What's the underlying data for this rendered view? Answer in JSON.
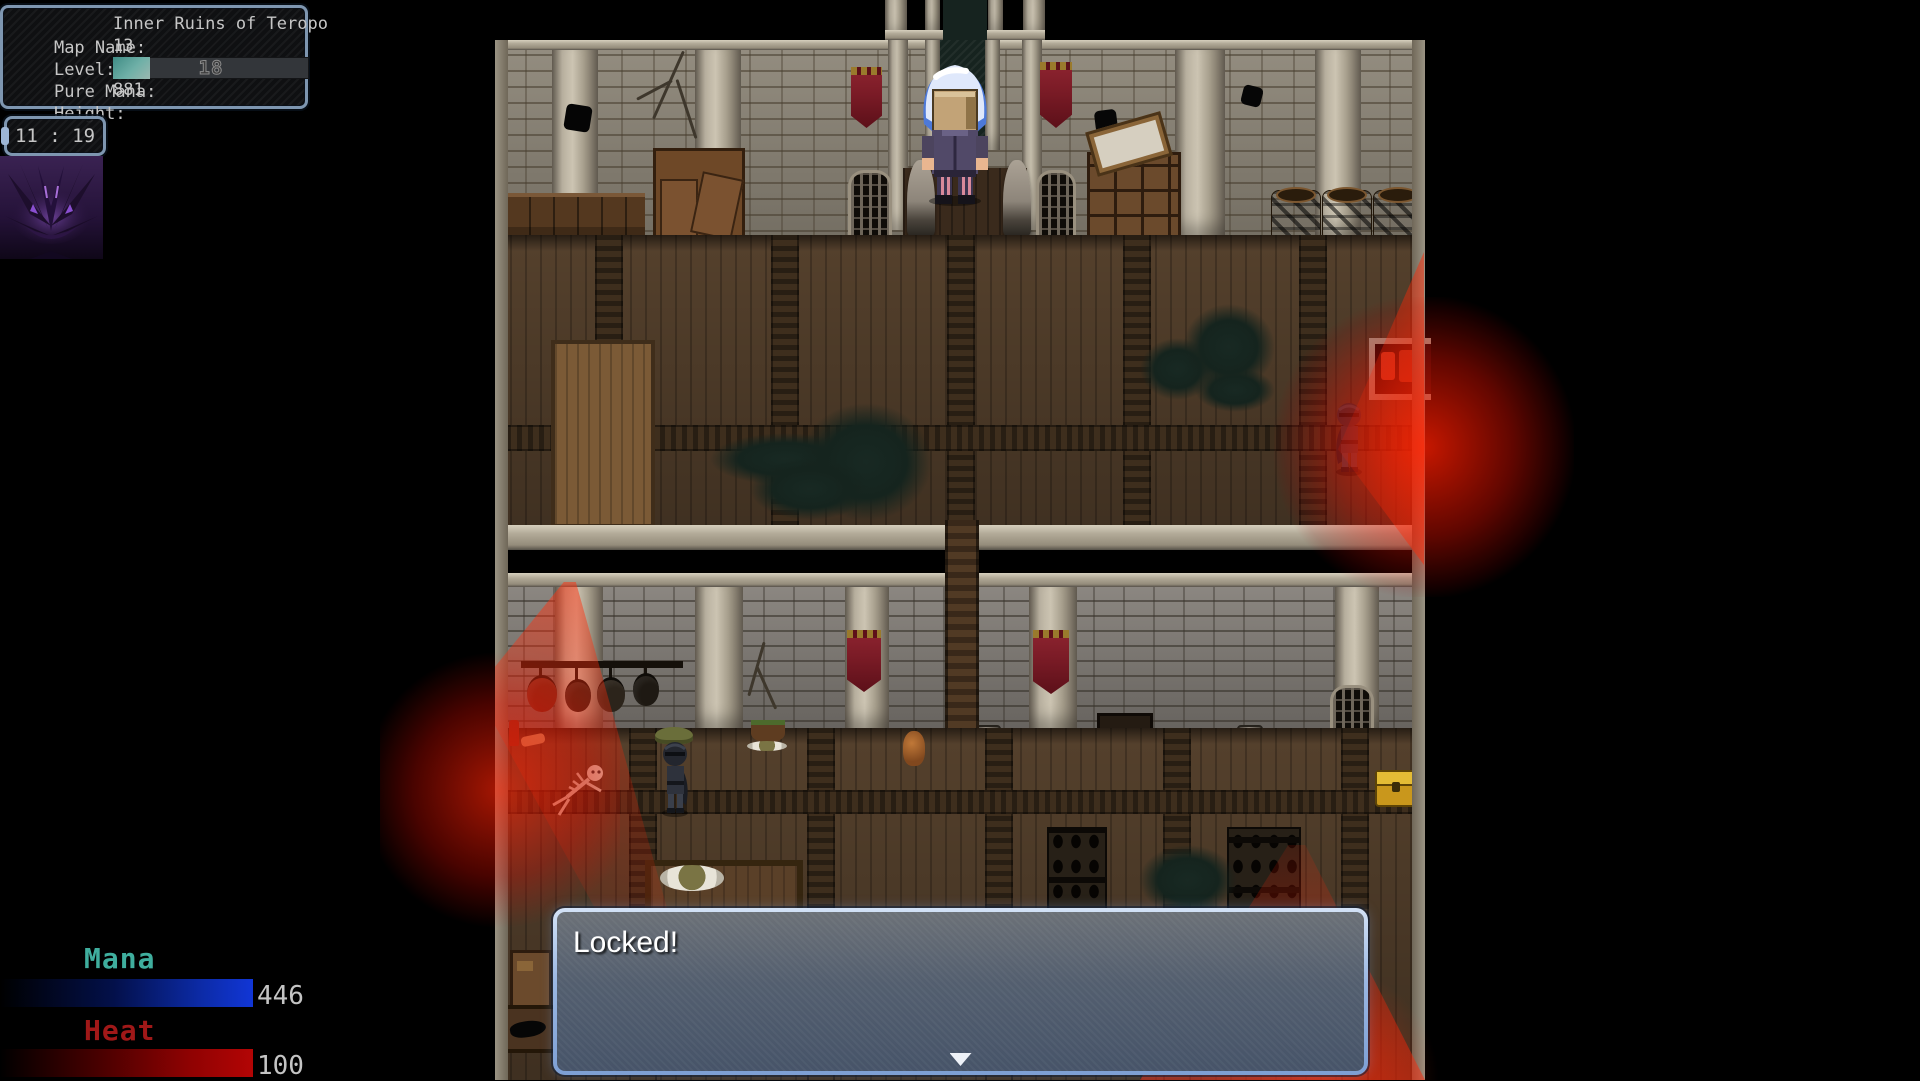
{
  "hud": {
    "map_name_label": "Map Name:",
    "map_name": "Inner Ruins of Teropo",
    "level_label": "Level:",
    "level": "13",
    "pure_mana_label": "Pure Mana:",
    "pure_mana": "18",
    "pure_mana_fill_pct": 19,
    "height_label": "Height:",
    "height": "881",
    "clock": "11 : 19",
    "mana_label": "Mana",
    "mana": "446",
    "heat_label": "Heat",
    "heat": "100"
  },
  "message": {
    "text": "Locked!",
    "continue_icon": "down-arrow"
  },
  "icons": {
    "portrait": "demon-portrait"
  },
  "colors": {
    "mana_accent": "#3fae9e",
    "heat_accent": "#a01818",
    "mana_bar_end": "#1136d6",
    "heat_bar_end": "#b30505",
    "pure_mana_bar": "#5a9a93",
    "message_border": "#9ab7e2",
    "red_light": "#ff2a00",
    "banner_red": "#7a1b26"
  }
}
